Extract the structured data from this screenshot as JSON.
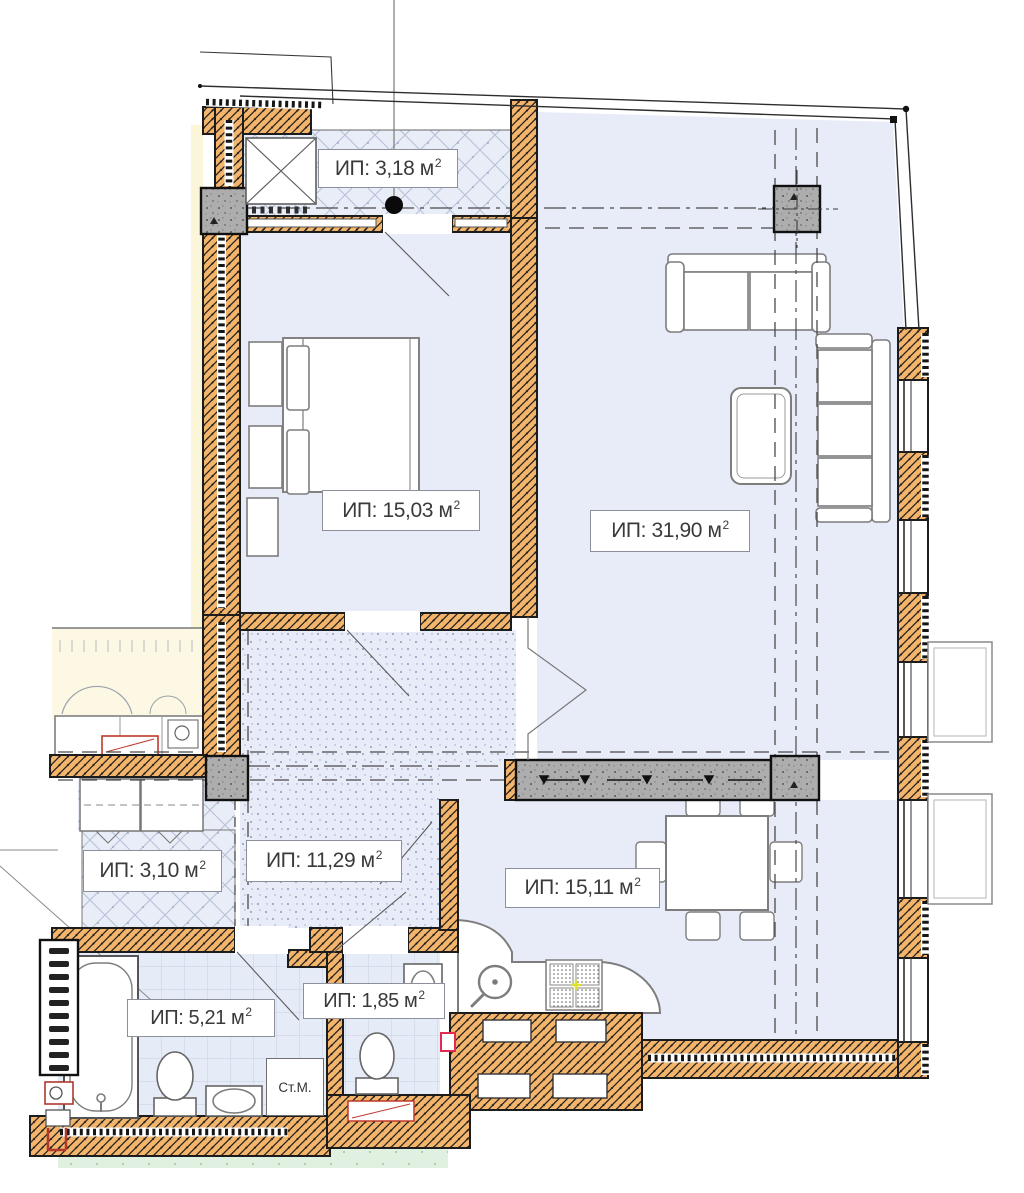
{
  "plan": {
    "rooms": {
      "top_balcony": {
        "label": "ИП: 3,18 м",
        "sup": "2"
      },
      "bedroom": {
        "label": "ИП: 15,03 м",
        "sup": "2"
      },
      "living_room": {
        "label": "ИП: 31,90 м",
        "sup": "2"
      },
      "hallway": {
        "label": "ИП: 11,29 м",
        "sup": "2"
      },
      "left_balcony": {
        "label": "ИП: 3,10 м",
        "sup": "2"
      },
      "kitchen": {
        "label": "ИП: 15,11 м",
        "sup": "2"
      },
      "bathroom": {
        "label": "ИП: 5,21 м",
        "sup": "2"
      },
      "wc": {
        "label": "ИП: 1,85 м",
        "sup": "2"
      }
    },
    "appliances": {
      "washing_machine": {
        "label": "Ст.М."
      }
    },
    "colors": {
      "wall_fill": "#f3b46c",
      "concrete": "#adadad",
      "room_fill": "#e8ecf8",
      "tile_fill": "#e5ebf7",
      "adjacent_fill": "#fbf6da",
      "lawn": "#e0f1e2",
      "accent_red": "#c0392b",
      "marker_red": "#e12a50",
      "line": "#1c1c1c"
    }
  }
}
